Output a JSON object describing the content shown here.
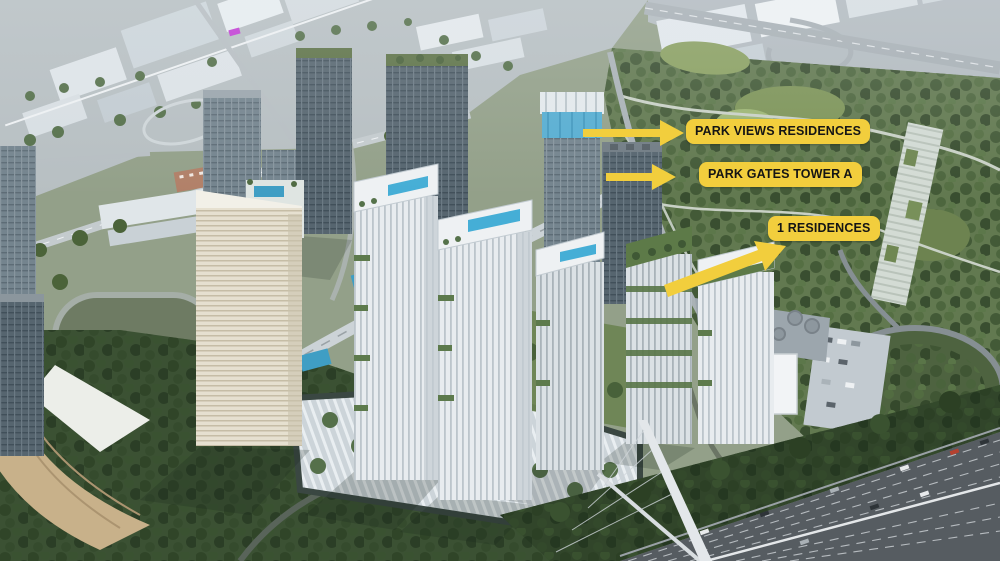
{
  "callouts": [
    {
      "label": "PARK VIEWS RESIDENCES",
      "arrow_icon": "arrow-right-icon"
    },
    {
      "label": "PARK GATES TOWER A",
      "arrow_icon": "arrow-right-icon"
    },
    {
      "label": "1 RESIDENCES",
      "arrow_icon": "arrow-up-right-icon"
    }
  ],
  "colors": {
    "callout_bg": "#F2CE3D",
    "callout_text": "#151515"
  }
}
